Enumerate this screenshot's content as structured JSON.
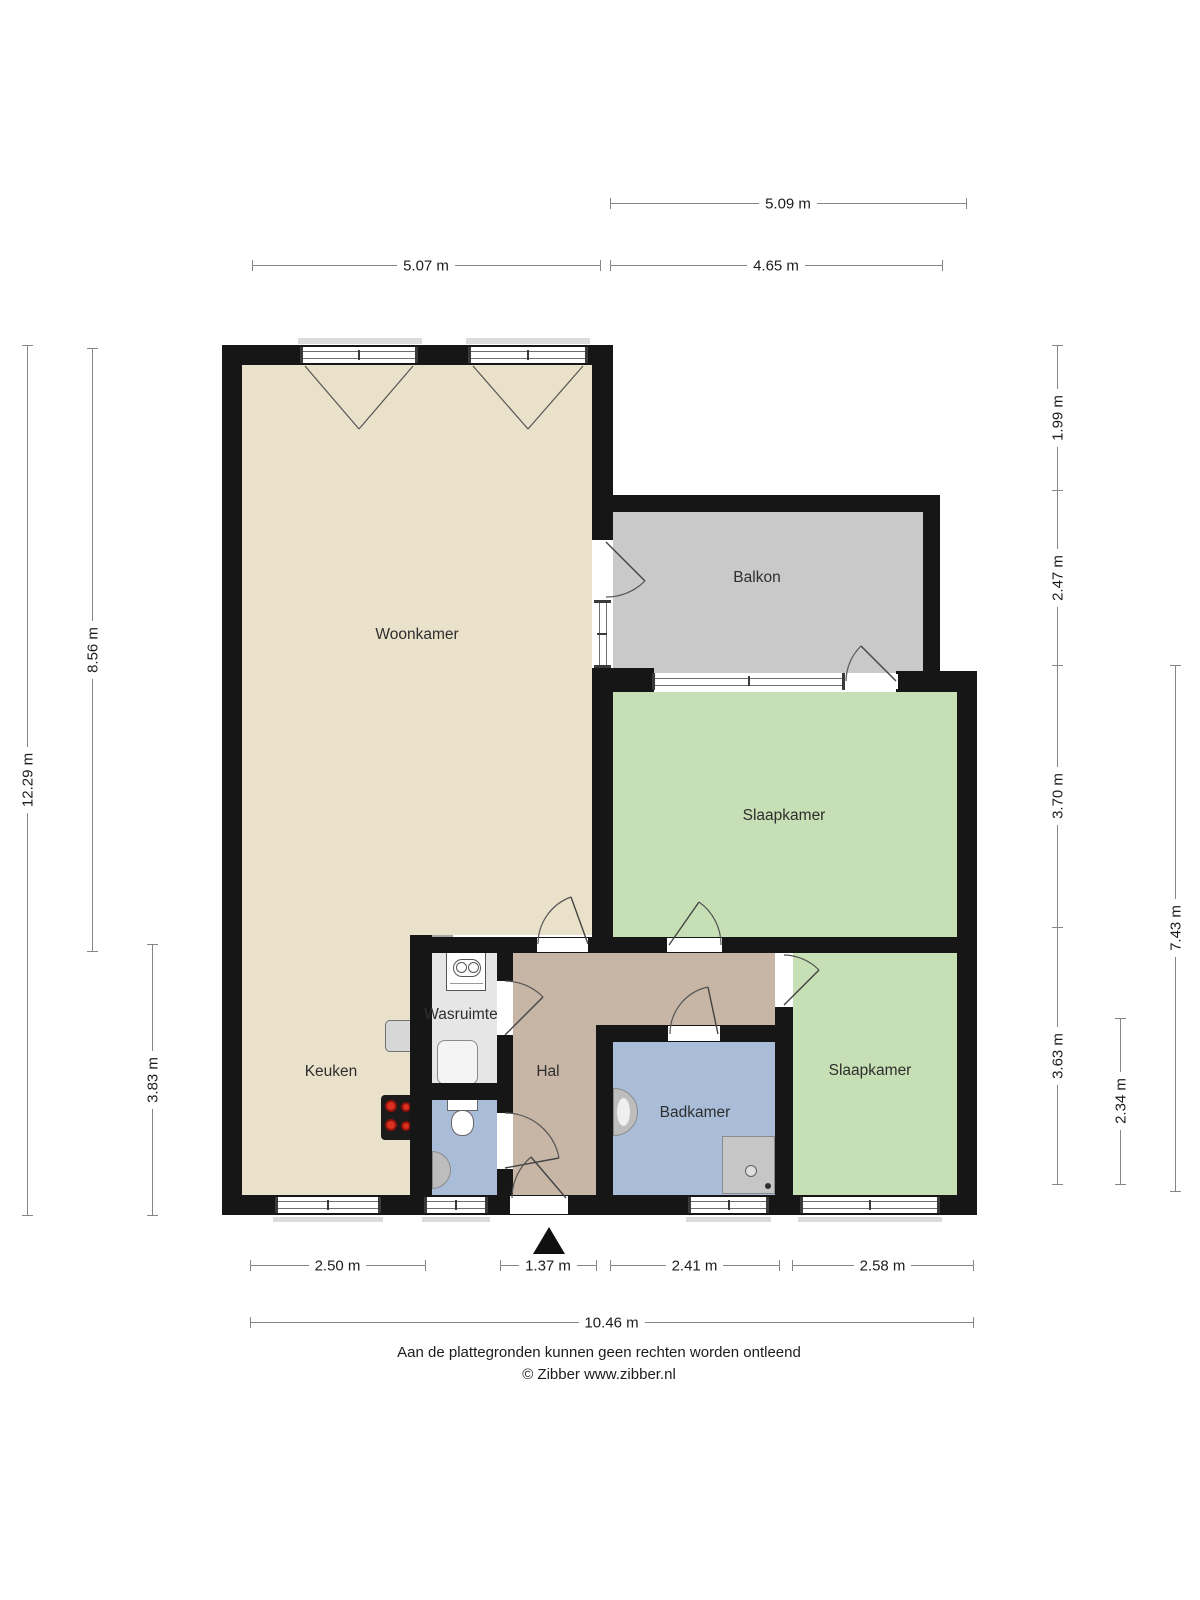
{
  "rooms": {
    "woonkamer": "Woonkamer",
    "balkon": "Balkon",
    "slaapkamer_1": "Slaapkamer",
    "slaapkamer_2": "Slaapkamer",
    "keuken": "Keuken",
    "wasruimte": "Wasruimte",
    "hal": "Hal",
    "badkamer": "Badkamer"
  },
  "dims": {
    "top_total": "5.09 m",
    "top_left": "5.07 m",
    "top_right": "4.65 m",
    "left_total": "12.29 m",
    "left_upper": "8.56 m",
    "left_lower": "3.83 m",
    "right_1": "1.99 m",
    "right_2": "2.47 m",
    "right_3": "3.70 m",
    "right_4": "3.63 m",
    "right_inner": "2.34 m",
    "right_total": "7.43 m",
    "bottom_1": "2.50 m",
    "bottom_2": "1.37 m",
    "bottom_3": "2.41 m",
    "bottom_4": "2.58 m",
    "bottom_total": "10.46 m"
  },
  "footer": {
    "disclaimer": "Aan de plattegronden kunnen geen rechten worden ontleend",
    "copyright": "© Zibber www.zibber.nl"
  },
  "colors": {
    "living": "#E9E1C9",
    "bedroom": "#C7DFB4",
    "balcony": "#C9C9C9",
    "hall": "#C7B6A6",
    "bath": "#A9BDD8",
    "laundry": "#E6E6E6",
    "wall": "#161616",
    "counter": "#AFAFAF",
    "counter_dark": "#A6A6A6"
  }
}
